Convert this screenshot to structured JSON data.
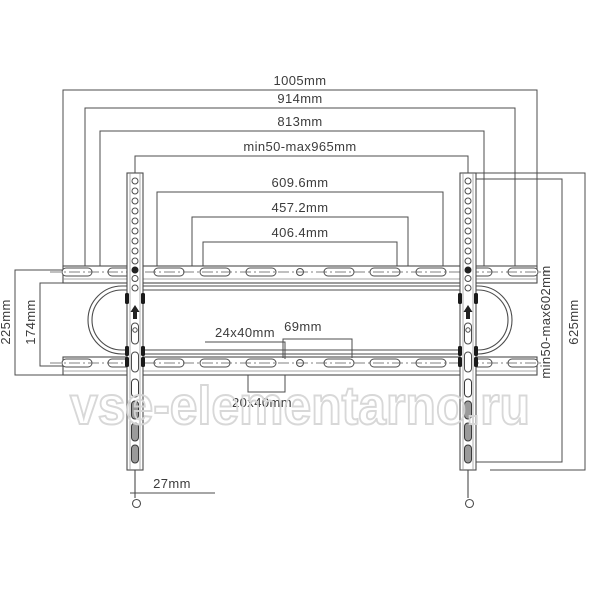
{
  "dims": {
    "top": [
      {
        "label": "1005mm"
      },
      {
        "label": "914mm"
      },
      {
        "label": "813mm"
      },
      {
        "label": "min50-max965mm"
      },
      {
        "label": "609.6mm"
      },
      {
        "label": "457.2mm"
      },
      {
        "label": "406.4mm"
      }
    ],
    "left": [
      {
        "label": "225mm"
      },
      {
        "label": "174mm"
      }
    ],
    "right": [
      {
        "label": "min50-max602mm"
      },
      {
        "label": "625mm"
      }
    ],
    "callouts": [
      {
        "label": "24x40mm"
      },
      {
        "label": "69mm"
      },
      {
        "label": "20x40mm"
      },
      {
        "label": "27mm"
      }
    ]
  },
  "watermark": {
    "text": "vse-elementarno.ru"
  },
  "colors": {
    "line": "#4c4c4c",
    "text": "#3c3c3c",
    "watermark_outline": "#d6d6d6"
  }
}
